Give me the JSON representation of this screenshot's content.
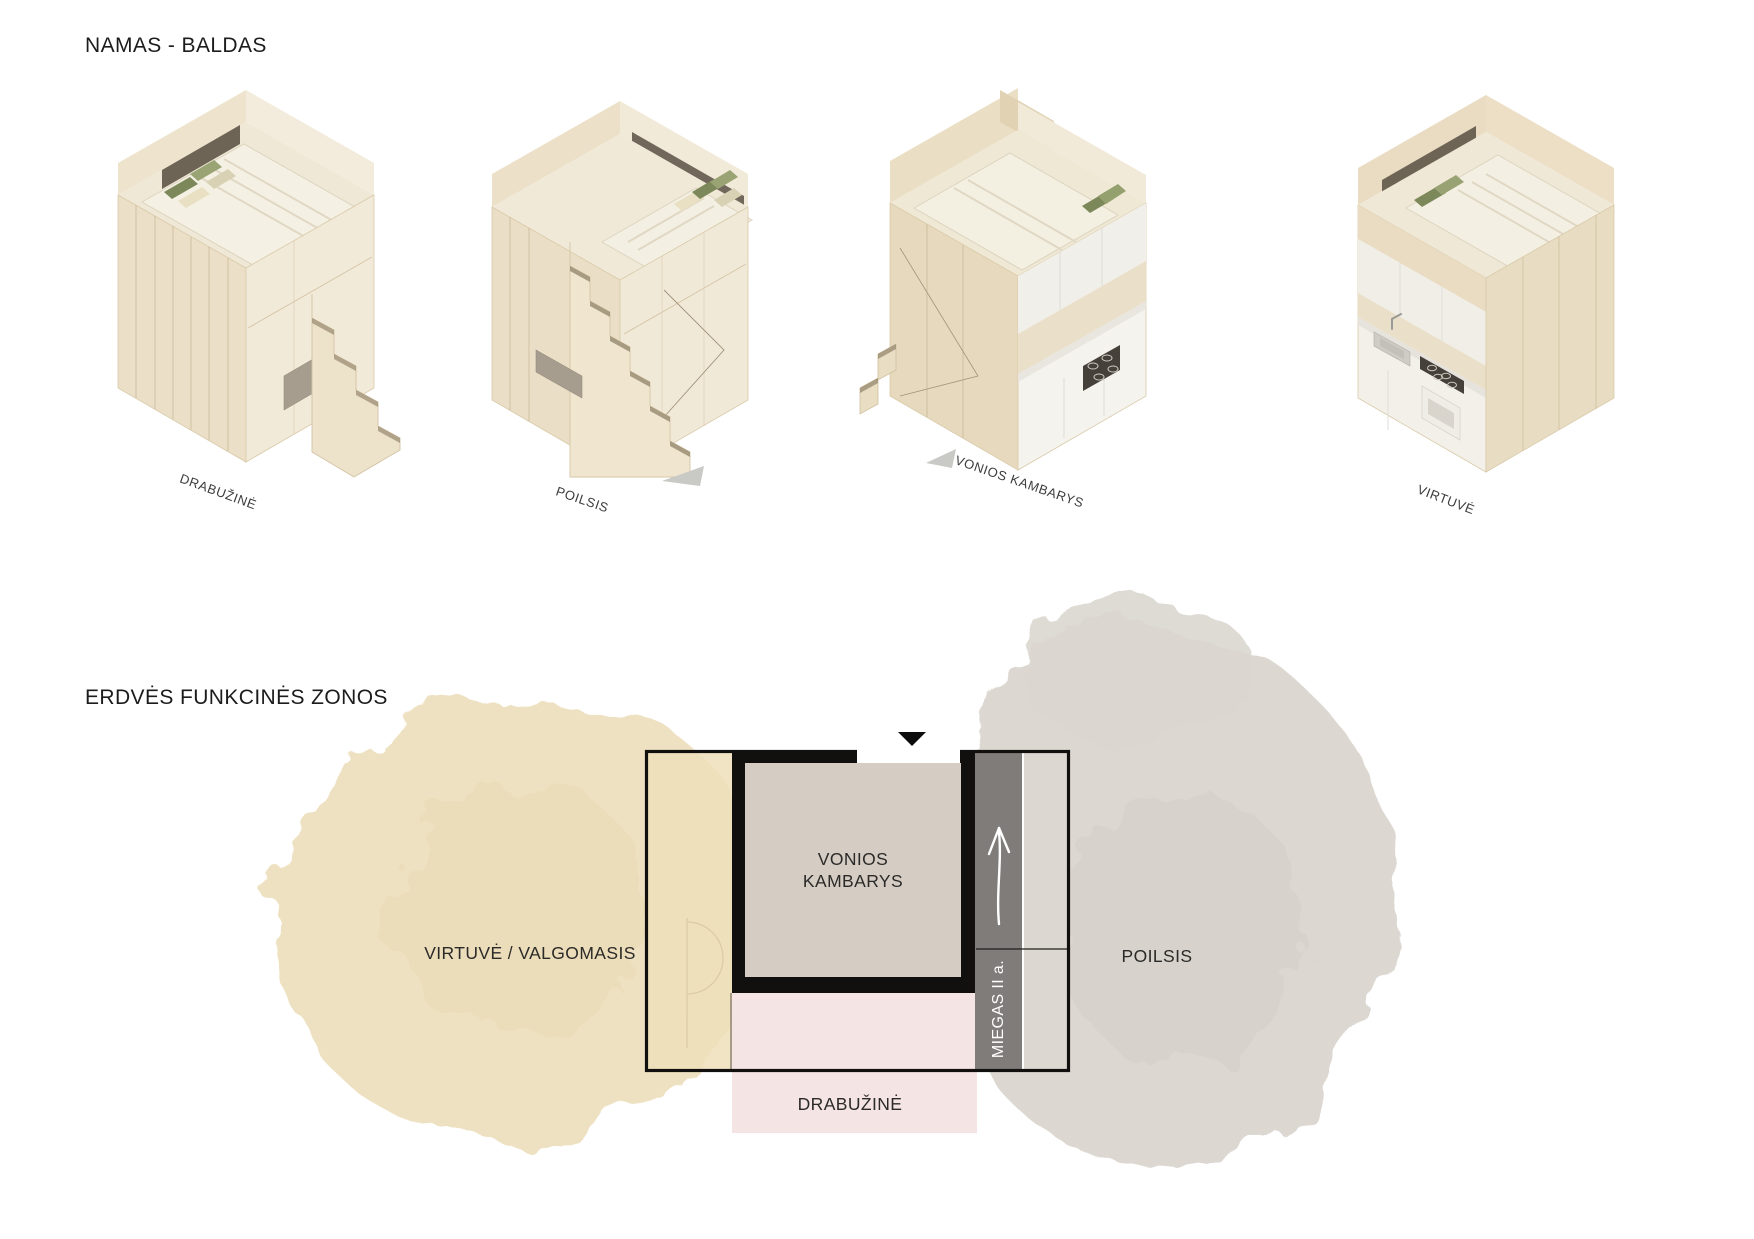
{
  "sections": {
    "furniture": {
      "title": "NAMAS - BALDAS",
      "modules": [
        {
          "id": "drabuzine",
          "label": "DRABUŽINĖ"
        },
        {
          "id": "poilsis",
          "label": "POILSIS"
        },
        {
          "id": "vonios-kambarys",
          "label": "VONIOS KAMBARYS"
        },
        {
          "id": "virtuve",
          "label": "VIRTUVĖ"
        }
      ]
    },
    "zones": {
      "title": "ERDVĖS FUNKCINĖS ZONOS",
      "plan": {
        "labels": {
          "kitchen_dining": "VIRTUVĖ / VALGOMASIS",
          "bathroom": "VONIOS KAMBARYS",
          "rest": "POILSIS",
          "sleep_second_floor": "MIEGAS II a.",
          "wardrobe": "DRABUŽINĖ"
        },
        "colors": {
          "kitchen_dining_zone": "#eee0be",
          "rest_zone": "#dbd7d0",
          "wardrobe_zone": "#f4e4e3",
          "bathroom_fill": "#d5cdc4",
          "stairs_strip": "#7f7c79",
          "wall": "#111111",
          "entry_marker": "#0d0d0d"
        }
      }
    }
  }
}
